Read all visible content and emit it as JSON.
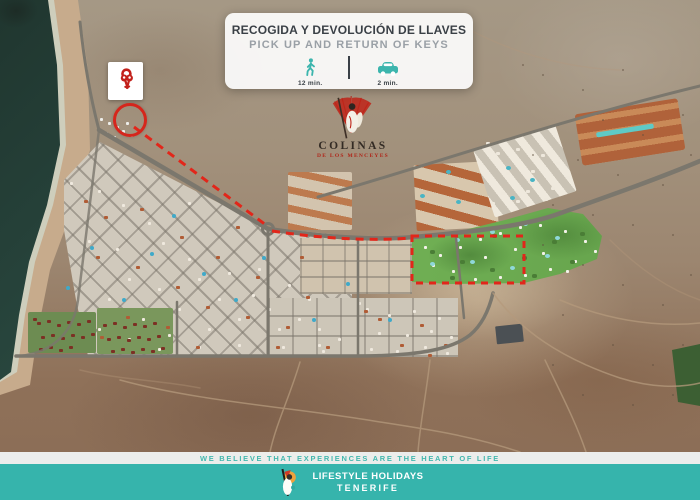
{
  "pickup_card": {
    "title_es": "RECOGIDA Y DEVOLUCIÓN DE LLAVES",
    "title_en": "PICK UP AND RETURN OF KEYS",
    "walk": {
      "icon": "walking-person-icon",
      "time": "12 min."
    },
    "drive": {
      "icon": "car-icon",
      "time": "2 min."
    }
  },
  "map": {
    "type": "satellite-aerial-view",
    "pickup_marker": {
      "icon": "keys-icon",
      "shape": "red-circle-outline"
    },
    "route": {
      "style": "red-dashed-line"
    },
    "highlight": {
      "style": "red-dashed-rectangle"
    },
    "resort_label": {
      "name": "COLINAS",
      "subtitle": "DE LOS MENCEYES",
      "icon": "colinas-crest-icon"
    }
  },
  "footer": {
    "tagline": "WE BELIEVE THAT EXPERIENCES ARE THE HEART OF LIFE",
    "brand": {
      "line1": "LIFESTYLE HOLIDAYS",
      "line2": "TENERIFE",
      "logo": "lifestyle-holidays-logo"
    }
  },
  "colors": {
    "accent_teal": "#3cb5ad",
    "brand_red": "#c2201a",
    "route_red": "#e2261a",
    "title_dark": "#3a4046",
    "subtitle_gray": "#9aa0a6",
    "ocean": "#2b4c43",
    "desert": "#9c8670",
    "resort_green": "#63a04b",
    "footer_teal": "#36b4ac"
  }
}
